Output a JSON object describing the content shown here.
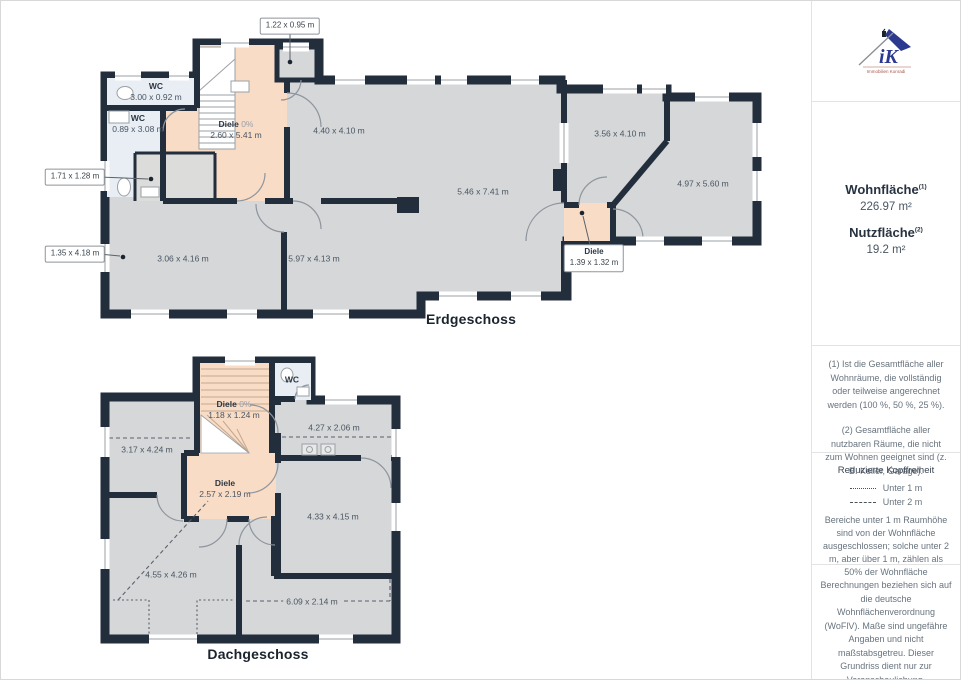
{
  "colors": {
    "wall": "#232e3d",
    "floor": "#d5d7d8",
    "hallway": "#f8dcc6",
    "wet_room": "#e9eef5",
    "logo_blue": "#2b3990"
  },
  "floors": [
    {
      "title": "Erdgeschoss",
      "title_x": 470,
      "title_y": 318,
      "labels": [
        {
          "x": 155,
          "y": 91,
          "name": "WC",
          "dims": "3.00 x 0.92 m"
        },
        {
          "x": 137,
          "y": 123,
          "name": "WC",
          "dims": "0.89 x 3.08 m"
        },
        {
          "x": 235,
          "y": 129,
          "name": "Diele",
          "pct": "0%",
          "dims": "2.60 x 5.41 m"
        },
        {
          "x": 338,
          "y": 130,
          "dims": "4.40 x 4.10 m"
        },
        {
          "x": 482,
          "y": 191,
          "dims": "5.46 x 7.41 m"
        },
        {
          "x": 619,
          "y": 133,
          "dims": "3.56 x 4.10 m"
        },
        {
          "x": 702,
          "y": 183,
          "dims": "4.97 x 5.60 m"
        },
        {
          "x": 182,
          "y": 258,
          "dims": "3.06 x 4.16 m"
        },
        {
          "x": 313,
          "y": 258,
          "dims": "5.97 x 4.13 m"
        }
      ],
      "callouts": [
        {
          "x": 289,
          "y": 25,
          "lines": [
            "1.22 x 0.95 m"
          ]
        },
        {
          "x": 74,
          "y": 176,
          "lines": [
            "1.71 x 1.28 m"
          ]
        },
        {
          "x": 74,
          "y": 253,
          "lines": [
            "1.35 x 4.18 m"
          ]
        },
        {
          "x": 593,
          "y": 257,
          "lines": [
            "Diele",
            "1.39 x 1.32 m"
          ]
        }
      ]
    },
    {
      "title": "Dachgeschoss",
      "title_x": 257,
      "title_y": 653,
      "labels": [
        {
          "x": 233,
          "y": 409,
          "name": "Diele",
          "pct": "0%",
          "dims": "1.18 x 1.24 m"
        },
        {
          "x": 291,
          "y": 379,
          "name": "WC"
        },
        {
          "x": 146,
          "y": 449,
          "dims": "3.17 x 4.24 m"
        },
        {
          "x": 333,
          "y": 427,
          "dims": "4.27 x 2.06 m"
        },
        {
          "x": 224,
          "y": 488,
          "name": "Diele",
          "dims": "2.57 x 2.19 m"
        },
        {
          "x": 332,
          "y": 516,
          "dims": "4.33 x 4.15 m"
        },
        {
          "x": 170,
          "y": 574,
          "dims": "4.55 x 4.26 m"
        },
        {
          "x": 311,
          "y": 601,
          "dims": "6.09 x 2.14 m",
          "bg": true
        }
      ],
      "callouts": []
    }
  ],
  "sidebar": {
    "logo": {
      "monogram": "iK",
      "caption": "Immobilien Konradi"
    },
    "areas": {
      "wohnflaeche": {
        "label": "Wohnfläche",
        "sup": "(1)",
        "value": "226.97 m²"
      },
      "nutzflaeche": {
        "label": "Nutzfläche",
        "sup": "(2)",
        "value": "19.2 m²"
      }
    },
    "notes": [
      "(1) Ist die Gesamtfläche aller Wohnräume, die vollständig oder teilweise angerechnet werden (100 %, 50 %, 25 %).",
      "(2) Gesamtfläche aller nutzbaren Räume, die nicht zum Wohnen geeignet sind (z. B. Keller, Garage)."
    ],
    "headroom": {
      "title": "Reduzierte Kopffreiheit",
      "legend": [
        {
          "style": "dotted",
          "label": "Unter 1 m"
        },
        {
          "style": "dashed",
          "label": "Unter 2 m"
        }
      ],
      "body": "Bereiche unter 1 m Raumhöhe sind von der Wohnfläche ausgeschlossen; solche unter 2 m, aber über 1 m, zählen als 50% der Wohnfläche"
    },
    "disclaimer": "Berechnungen beziehen sich auf die deutsche Wohnflächenverordnung (WoFlV). Maße sind ungefähre Angaben und nicht maßstabsgetreu. Dieser Grundriss dient nur zur Veranschaulichung.",
    "brand": {
      "name": "GIRAFFE",
      "suffix": "360"
    }
  }
}
